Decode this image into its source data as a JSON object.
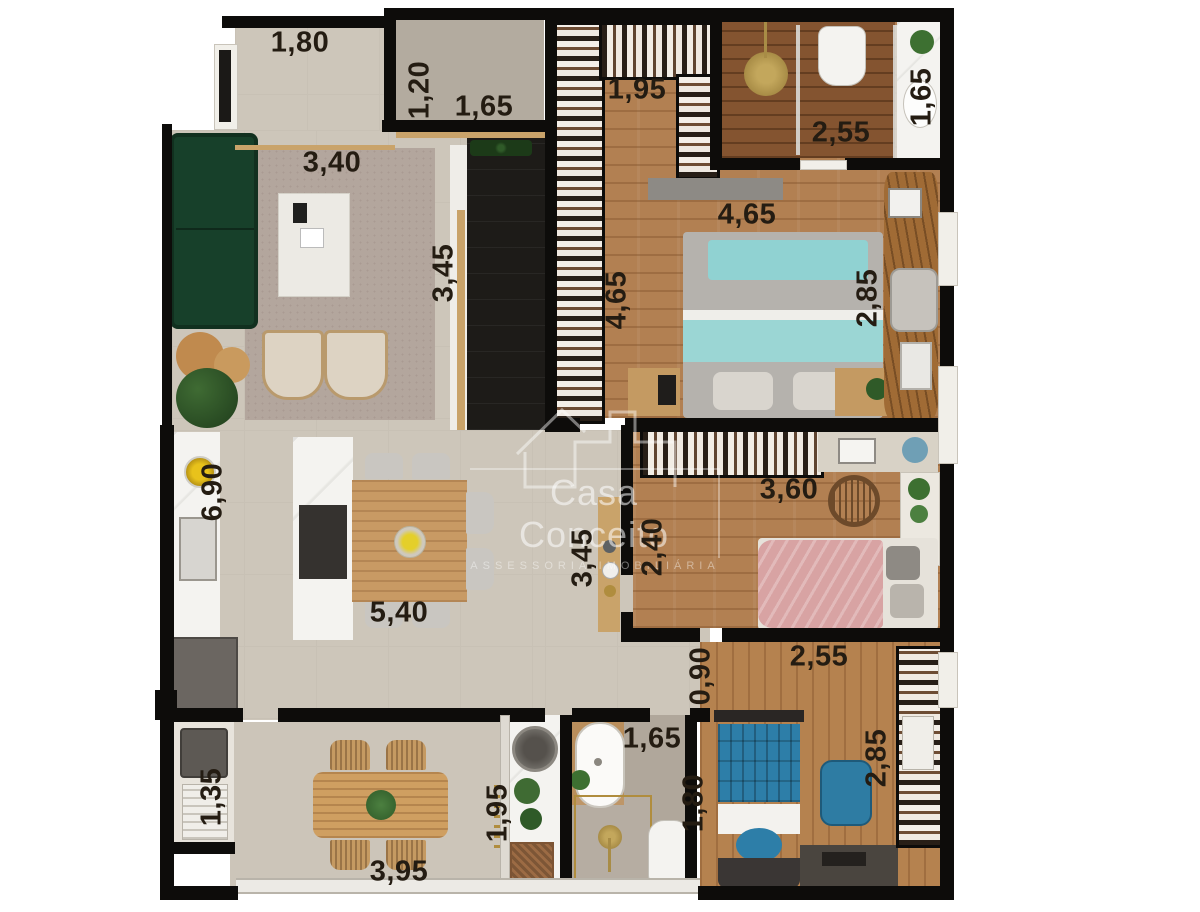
{
  "watermark": {
    "title": "Casa Conceito",
    "subtitle": "ASSESSORIA IMOBILIÁRIA"
  },
  "dimension_labels": [
    {
      "room": "entry-hall",
      "text": "1,80",
      "x": 300,
      "y": 43,
      "rot": 0
    },
    {
      "room": "powder-room-depth",
      "text": "1,20",
      "x": 420,
      "y": 90,
      "rot": -90
    },
    {
      "room": "powder-room-width",
      "text": "1,65",
      "x": 484,
      "y": 107,
      "rot": 0
    },
    {
      "room": "closet",
      "text": "1,95",
      "x": 637,
      "y": 90,
      "rot": 0
    },
    {
      "room": "master-shower-width",
      "text": "2,55",
      "x": 841,
      "y": 133,
      "rot": 0
    },
    {
      "room": "master-vanity",
      "text": "1,65",
      "x": 922,
      "y": 97,
      "rot": -90
    },
    {
      "room": "living-width",
      "text": "3,40",
      "x": 332,
      "y": 163,
      "rot": 0
    },
    {
      "room": "living-depth",
      "text": "3,45",
      "x": 444,
      "y": 273,
      "rot": -90
    },
    {
      "room": "master-width",
      "text": "4,65",
      "x": 747,
      "y": 215,
      "rot": 0
    },
    {
      "room": "master-depth",
      "text": "4,65",
      "x": 617,
      "y": 300,
      "rot": -90
    },
    {
      "room": "master-desk-wall",
      "text": "2,85",
      "x": 868,
      "y": 298,
      "rot": -90
    },
    {
      "room": "kitchen-depth",
      "text": "6,90",
      "x": 213,
      "y": 492,
      "rot": -90
    },
    {
      "room": "bedroom2-width",
      "text": "3,60",
      "x": 789,
      "y": 490,
      "rot": 0
    },
    {
      "room": "bedroom2-depth",
      "text": "2,40",
      "x": 653,
      "y": 547,
      "rot": -90
    },
    {
      "room": "hall-depth",
      "text": "3,45",
      "x": 583,
      "y": 558,
      "rot": -90
    },
    {
      "room": "dining-width",
      "text": "5,40",
      "x": 399,
      "y": 613,
      "rot": 0
    },
    {
      "room": "corridor",
      "text": "0,90",
      "x": 701,
      "y": 676,
      "rot": -90
    },
    {
      "room": "bedroom3-width",
      "text": "2,55",
      "x": 819,
      "y": 657,
      "rot": 0
    },
    {
      "room": "bedroom3-depth",
      "text": "2,85",
      "x": 877,
      "y": 758,
      "rot": -90
    },
    {
      "room": "terrace-utility",
      "text": "1,35",
      "x": 212,
      "y": 797,
      "rot": -90
    },
    {
      "room": "bathroom-width",
      "text": "1,65",
      "x": 652,
      "y": 739,
      "rot": 0
    },
    {
      "room": "bathroom-depth",
      "text": "1,80",
      "x": 694,
      "y": 803,
      "rot": -90
    },
    {
      "room": "laundry",
      "text": "1,95",
      "x": 498,
      "y": 813,
      "rot": -90
    },
    {
      "room": "terrace-width",
      "text": "3,95",
      "x": 399,
      "y": 872,
      "rot": 0
    }
  ],
  "palette": {
    "wall": "#0d0c0a",
    "floor_beige": "#cdc6ba",
    "floor_wood": "#b28052",
    "floor_wood_dark": "#845430",
    "deck": "#1d1b18",
    "marble": "#f4f3f0",
    "sofa_green": "#17402a",
    "bed_teal": "#90d2d2",
    "bed_pink": "#d9a8a8",
    "bed_blue": "#2d7ea8",
    "accent_gold": "#b08d3e",
    "label_text": "#241c12"
  }
}
